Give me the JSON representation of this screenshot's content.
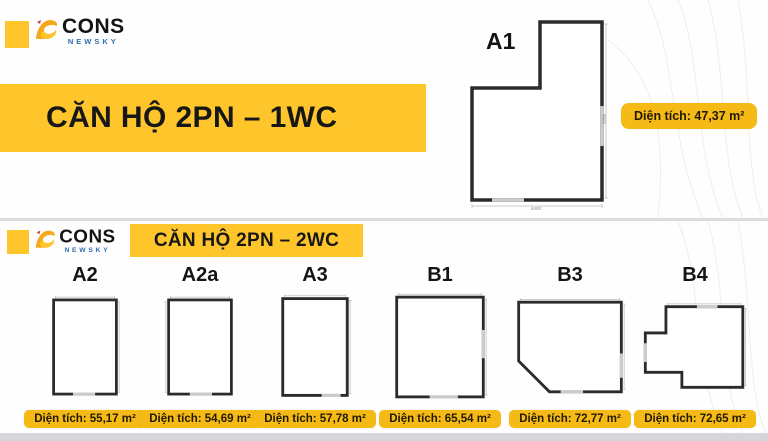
{
  "brand": {
    "prefix": "b",
    "name": "CONS",
    "subtitle": "NEWSKY"
  },
  "top_section": {
    "title": "CĂN HỘ 2PN – 1WC",
    "plan": {
      "label": "A1",
      "area_label": "Diện tích: 47,37 m²",
      "dim_width": "6400",
      "dim_height": "8600"
    }
  },
  "bottom_section": {
    "title": "CĂN HỘ 2PN – 2WC",
    "plans": [
      {
        "label": "A2",
        "area_label": "Diện tích: 55,17 m²"
      },
      {
        "label": "A2a",
        "area_label": "Diện tích: 54,69 m²"
      },
      {
        "label": "A3",
        "area_label": "Diện tích: 57,78 m²"
      },
      {
        "label": "B1",
        "area_label": "Diện tích: 65,54 m²"
      },
      {
        "label": "B3",
        "area_label": "Diện tích: 72,77 m²"
      },
      {
        "label": "B4",
        "area_label": "Diện tích: 72,65 m²"
      }
    ]
  },
  "colors": {
    "accent_yellow": "#FFC62B",
    "badge_yellow": "#F6BA17",
    "newsky_blue": "#2E6DB4",
    "title_text": "#171717"
  }
}
